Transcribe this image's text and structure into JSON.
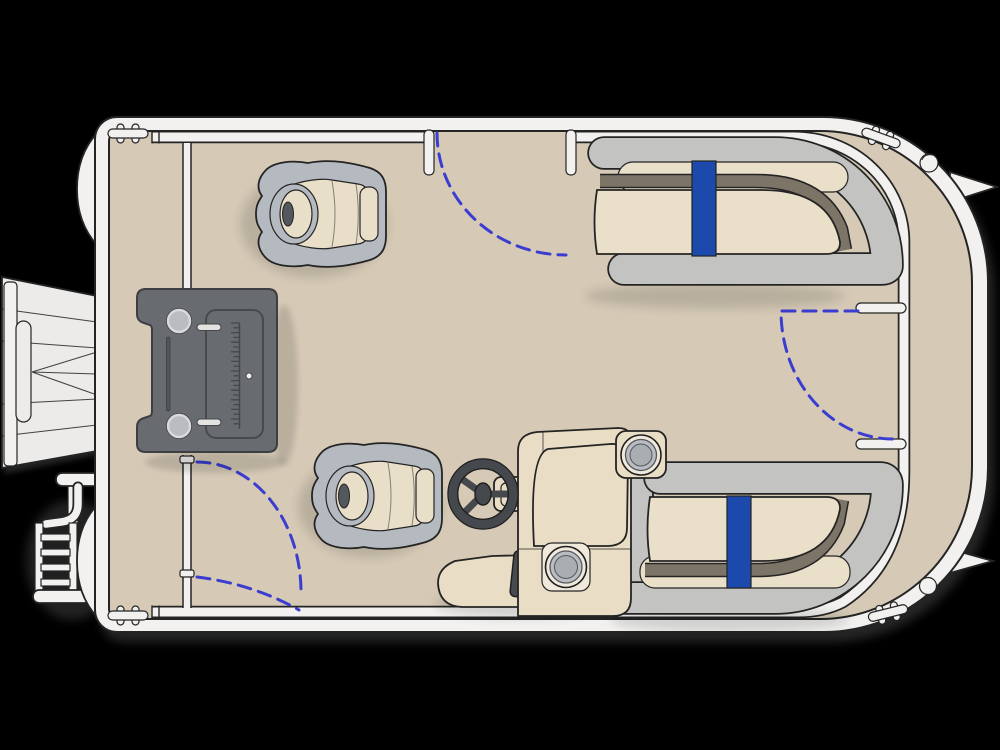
{
  "title": "Pontoon boat floor plan - top view",
  "canvas": {
    "width": 1000,
    "height": 750
  },
  "colors": {
    "bg": "#000000",
    "deck": "#d6cab6",
    "rail": "#f2f1ef",
    "outline": "#242424",
    "seat_gray": "#c3c3c2",
    "cushion": "#eadfc9",
    "trim": "#7d7468",
    "accent": "#1b49ac",
    "chair_gray": "#b5bac1",
    "chair_cushion": "#e9dfc9",
    "chair_dark": "#54585e",
    "table": "#686c70",
    "table_metal": "#b9bdc2",
    "console": "#e9ddc5",
    "wheel": "#45484d",
    "dash": "#3b3dd1"
  },
  "inventory": {
    "captain_chairs": 2,
    "stern_lounge_seats": 2,
    "gate_swing_arcs": 3,
    "cleats": 4,
    "cup_holders": 4,
    "bow_boarding_ramp": 1,
    "boarding_ladder": 1,
    "steering_wheel": 1,
    "table_with_ruler": 1,
    "deck_lights": 2,
    "stern_nav_fins": 2
  }
}
